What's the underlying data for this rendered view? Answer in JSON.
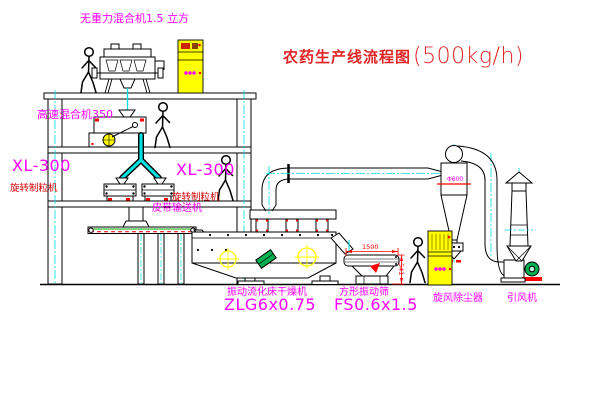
{
  "title": {
    "name": "农药生产线流程图",
    "capacity": "(500kg/h)"
  },
  "labels": {
    "gravity_mixer": "无重力混合机1.5 立方",
    "high_speed_mixer": "高速混合机350",
    "granulator_left_model": "XL-300",
    "granulator_left_name": "旋转制粒机",
    "granulator_right_model": "XL-300",
    "granulator_right_name": "旋转制粒机",
    "belt_conveyor": "皮带输送机",
    "fluid_bed_dryer_name": "振动流化床干燥机",
    "fluid_bed_dryer_model": "ZLG6x0.75",
    "vibrating_sieve_name": "方形振动筛",
    "vibrating_sieve_model": "FS0.6x1.5",
    "cyclone_dust_collector": "旋风除尘器",
    "induced_draft_fan": "引风机"
  },
  "dimensions": {
    "sieve_length": "1500",
    "sieve_height": "541",
    "cyclone_note": "Φ600"
  },
  "colors": {
    "annotation_magenta": "#ff00ff",
    "annotation_red": "#d40000",
    "centerline_cyan": "#00e0e0",
    "cabinet_yellow": "#ffff00",
    "motor_green": "#00b050",
    "drawing_black": "#000000",
    "background": "#ffffff"
  }
}
